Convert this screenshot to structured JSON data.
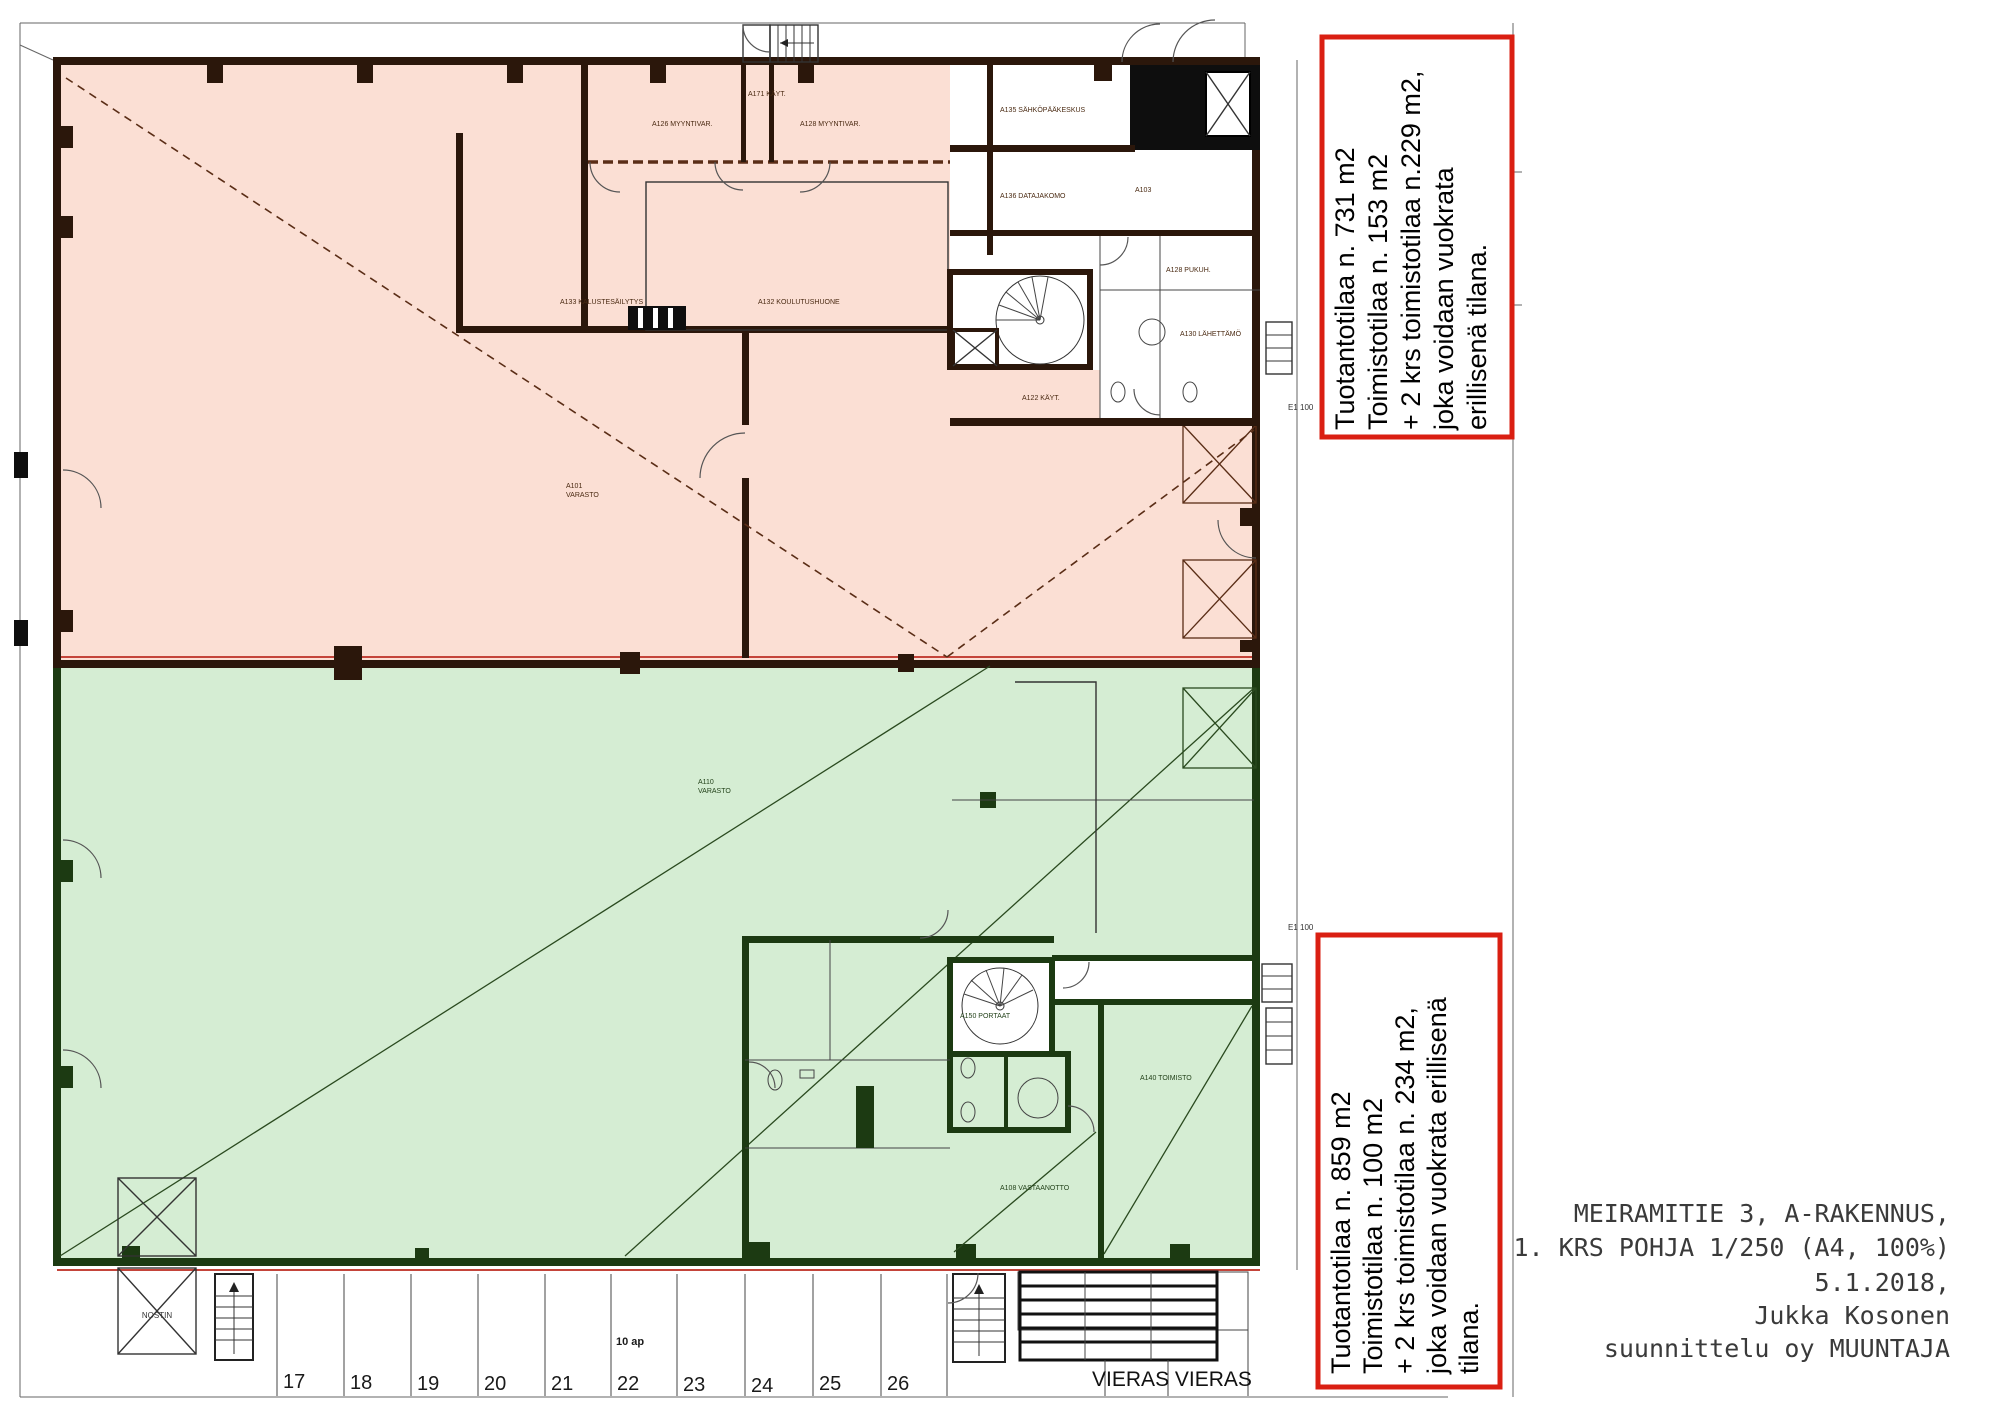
{
  "drawing": {
    "type": "floor-plan",
    "building": "A-rakennus",
    "floor": "1. krs"
  },
  "colors": {
    "upper_zone_fill": "#fbdfd4",
    "lower_zone_fill": "#d5edd3",
    "upper_wall": "#2b170b",
    "lower_wall": "#1c3a12",
    "annotation_border": "#da1f12",
    "area_boundary_line": "#c4443a"
  },
  "annotations": {
    "box_upper": {
      "lines": [
        "Tuotantotilaa n. 731 m2",
        "Toimistotilaa n. 153 m2",
        "+ 2 krs toimistotilaa n.229 m2,",
        "joka voidaan vuokrata",
        "erillisenä tilana."
      ]
    },
    "box_lower": {
      "lines": [
        "Tuotantotilaa n. 859 m2",
        "Toimistotilaa n. 100 m2",
        "+ 2 krs toimistotilaa n. 234 m2,",
        "joka voidaan vuokrata erillisenä",
        "tilana."
      ]
    }
  },
  "title_block": {
    "lines": [
      "MEIRAMITIE 3, A-RAKENNUS,",
      "1. KRS POHJA 1/250 (A4, 100%)",
      "5.1.2018,",
      "Jukka Kosonen",
      "suunnittelu oy MUUNTAJA"
    ]
  },
  "parking": {
    "stalls": [
      "17",
      "18",
      "19",
      "20",
      "21",
      "22",
      "23",
      "24",
      "25",
      "26"
    ],
    "capacity_label": "10 ap",
    "visitor_label": "VIERAS VIERAS"
  },
  "rooms": {
    "myyntivar1": "A126 MYYNTIVAR.",
    "kaytava": "A171 KÄYT.",
    "myyntivar2": "A128 MYYNTIVAR.",
    "koulutus": "A132 KOULUTUSHUONE",
    "kaluste": "A133 KALUSTESÄILYTYS",
    "varasto1_id": "A101",
    "varasto1_name": "VARASTO",
    "sahko": "A135 SÄHKÖPÄÄKESKUS",
    "data": "A136 DATAJAKOMO",
    "a103": "A103",
    "pukuh": "A128 PUKUH.",
    "lahettamo": "A130 LÄHETTÄMÖ",
    "kayt2": "A122 KÄYT.",
    "varasto2_id": "A110",
    "varasto2_name": "VARASTO",
    "portaat": "A150 PORTAAT",
    "toimisto": "A140 TOIMISTO",
    "vastaanotto": "A108 VASTAANOTTO",
    "nostin": "NOSTIN",
    "marker_e1": "E1 100"
  }
}
